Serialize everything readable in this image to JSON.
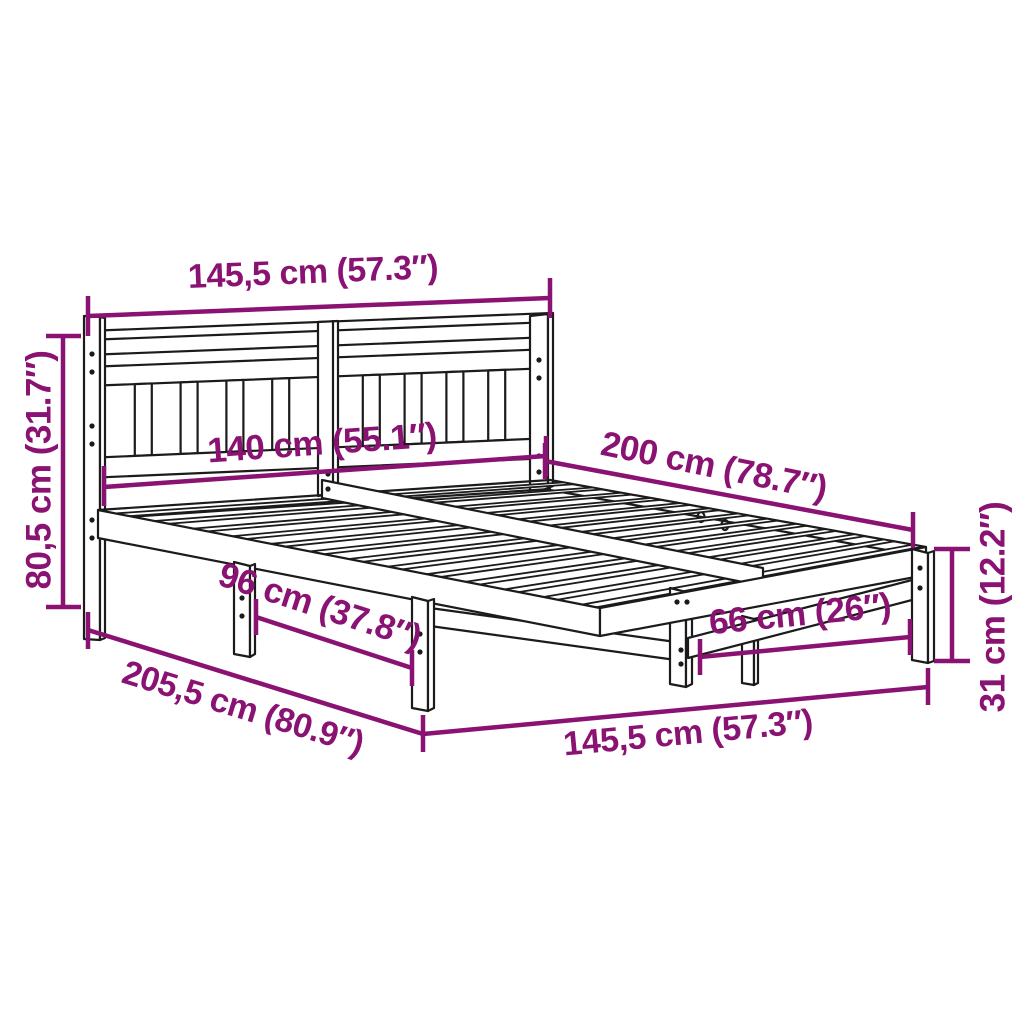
{
  "title": "Bed frame dimension diagram",
  "colors": {
    "dimension_accent": "#8A1273",
    "line_art": "#1B1B1B",
    "background": "#FFFFFF"
  },
  "labels": {
    "top_width": "145,5 cm (57.3″)",
    "headboard_height": "80,5 cm (31.7″)",
    "mattress_width": "140 cm (55.1″)",
    "mattress_length": "200 cm (78.7″)",
    "side_leg_spacing": "96 cm (37.8″)",
    "total_length": "205,5 cm (80.9″)",
    "foot_leg_spacing": "66 cm (26″)",
    "foot_width": "145,5 cm (57.3″)",
    "leg_height": "31 cm (12.2″)"
  }
}
